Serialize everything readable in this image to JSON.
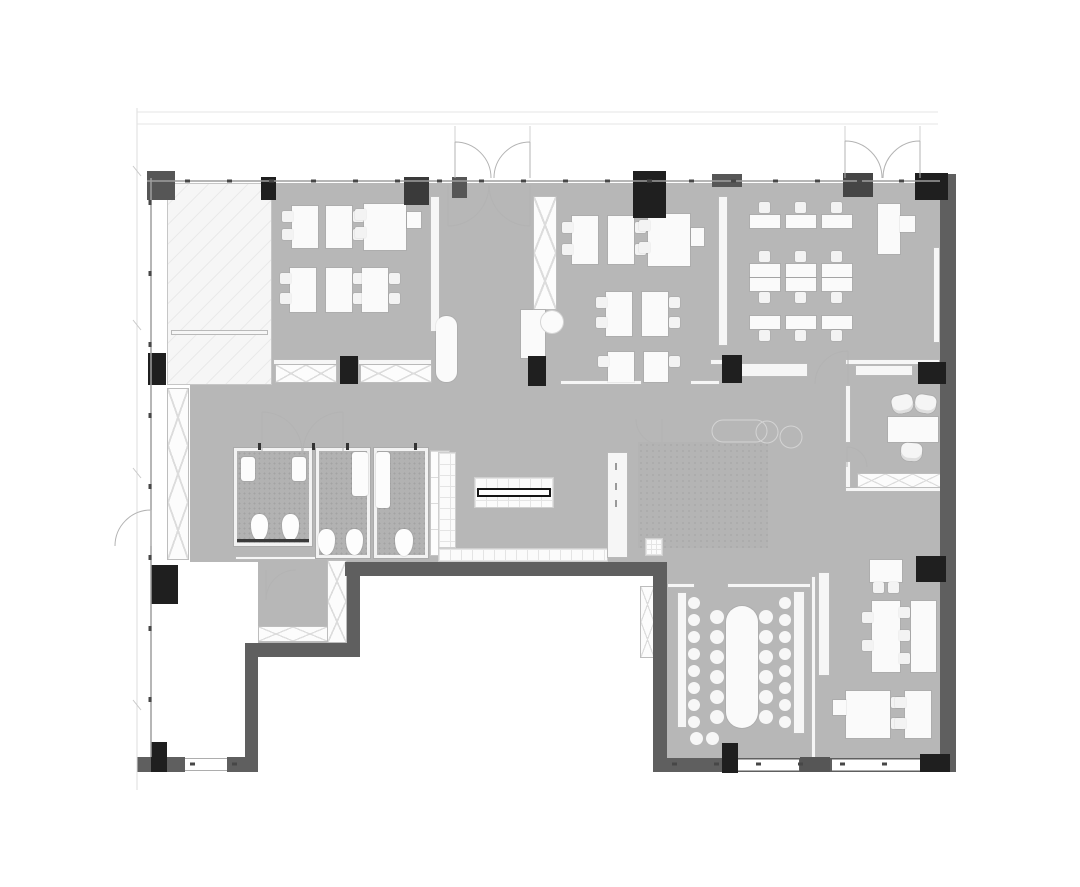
{
  "meta": {
    "title": "Office floor plan",
    "type": "architectural-floor-plan",
    "orientation": "top-down"
  },
  "palette": {
    "bg": "#ffffff",
    "floor": "#b7b7b7",
    "floorBath": "#b2b2b2",
    "wall": "#5f5f5f",
    "colBlack": "#1f1f1f",
    "colGray": "#565656",
    "furnWhite": "#fafafa",
    "partBorder": "#b9b9b9",
    "lineMid": "#9e9e9e",
    "lineLight": "#d8d8d8",
    "tickDark": "#474747"
  },
  "rooms": [
    {
      "id": "core",
      "label": "Building core / stair lobby (hatched)"
    },
    {
      "id": "office-a",
      "label": "Office A — workstation pods"
    },
    {
      "id": "entrance",
      "label": "Entrance lobby with double doors"
    },
    {
      "id": "office-b",
      "label": "Office B — workstation pods"
    },
    {
      "id": "training",
      "label": "Training room — desk rows and lectern"
    },
    {
      "id": "corridor",
      "label": "Open corridor / lounge area"
    },
    {
      "id": "wc-a",
      "label": "WC A — two stalls, two basins"
    },
    {
      "id": "wc-b",
      "label": "WC B — two stalls"
    },
    {
      "id": "wc-c",
      "label": "WC C — single stall"
    },
    {
      "id": "pantry",
      "label": "Pantry / bar island"
    },
    {
      "id": "private-office",
      "label": "Private office"
    },
    {
      "id": "conference",
      "label": "Conference room — long table with bench seating"
    },
    {
      "id": "open-office",
      "label": "Open office — lower right"
    },
    {
      "id": "vestibule",
      "label": "Rear vestibule"
    }
  ],
  "fixtures": {
    "toilets": 5,
    "sinks": 4,
    "entrance_double_doors": 2,
    "workstation_pods": 13,
    "training_desk_columns": 3,
    "training_desk_rows": 3,
    "lectern": 1,
    "conference_table_seats": 12,
    "conference_wall_stools": 16,
    "lounge_chairs": 2,
    "private_office_seats": 3,
    "open_office_desks": 9,
    "pantry_counter_label_marks": 3
  }
}
